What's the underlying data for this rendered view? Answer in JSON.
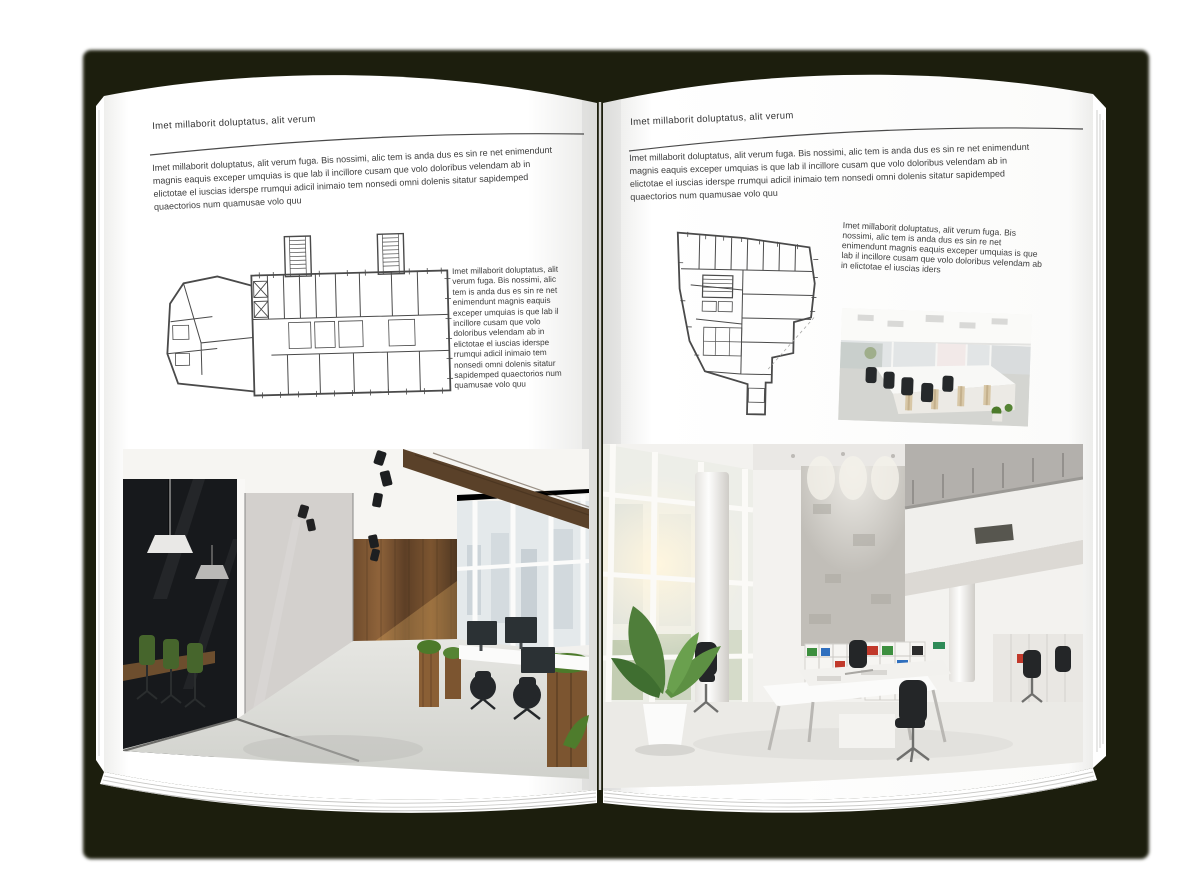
{
  "scene": {
    "shadow_color": "#1c1e0d",
    "page_color": "#ffffff",
    "text_color": "#3c3c3c",
    "plan_line_color": "#4a4a4a"
  },
  "left_page": {
    "header": "Imet millaborit doluptatus, alit verum",
    "intro": "Imet millaborit doluptatus, alit verum fuga. Bis nossimi, alic tem is anda dus es sin re net enimendunt magnis eaquis exceper umquias is que lab il incillore cusam que volo doloribus velendam ab in elictotae el iuscias iderspe rrumqui adicil inimaio tem nonsedi omni dolenis sitatur sapidemped quaectorios num quamusae volo quu",
    "side_text": "Imet millaborit doluptatus, alit verum fuga. Bis nossimi, alic tem is anda dus es sin re net enimendunt magnis eaquis exceper umquias is que lab il incillore cusam que volo doloribus velendam ab in elictotae el iuscias iderspe rrumqui adicil inimaio tem nonsedi omni dolenis sitatur sapidemped quaectorios num quamusae volo quu"
  },
  "right_page": {
    "header": "Imet millaborit doluptatus, alit verum",
    "intro": "Imet millaborit doluptatus, alit verum fuga. Bis nossimi, alic tem is anda dus es sin re net enimendunt magnis eaquis exceper umquias is que lab il incillore cusam que volo doloribus velendam ab in elictotae el iuscias iderspe rrumqui adicil inimaio tem nonsedi omni dolenis sitatur sapidemped quaectorios num quamusae volo quu",
    "side_text": "Imet millaborit doluptatus, alit verum fuga. Bis nossimi, alic tem is anda dus es sin re net enimendunt magnis eaquis exceper umquias is que lab il incillore cusam que volo doloribus velendam ab in elictotae el iuscias iders"
  }
}
